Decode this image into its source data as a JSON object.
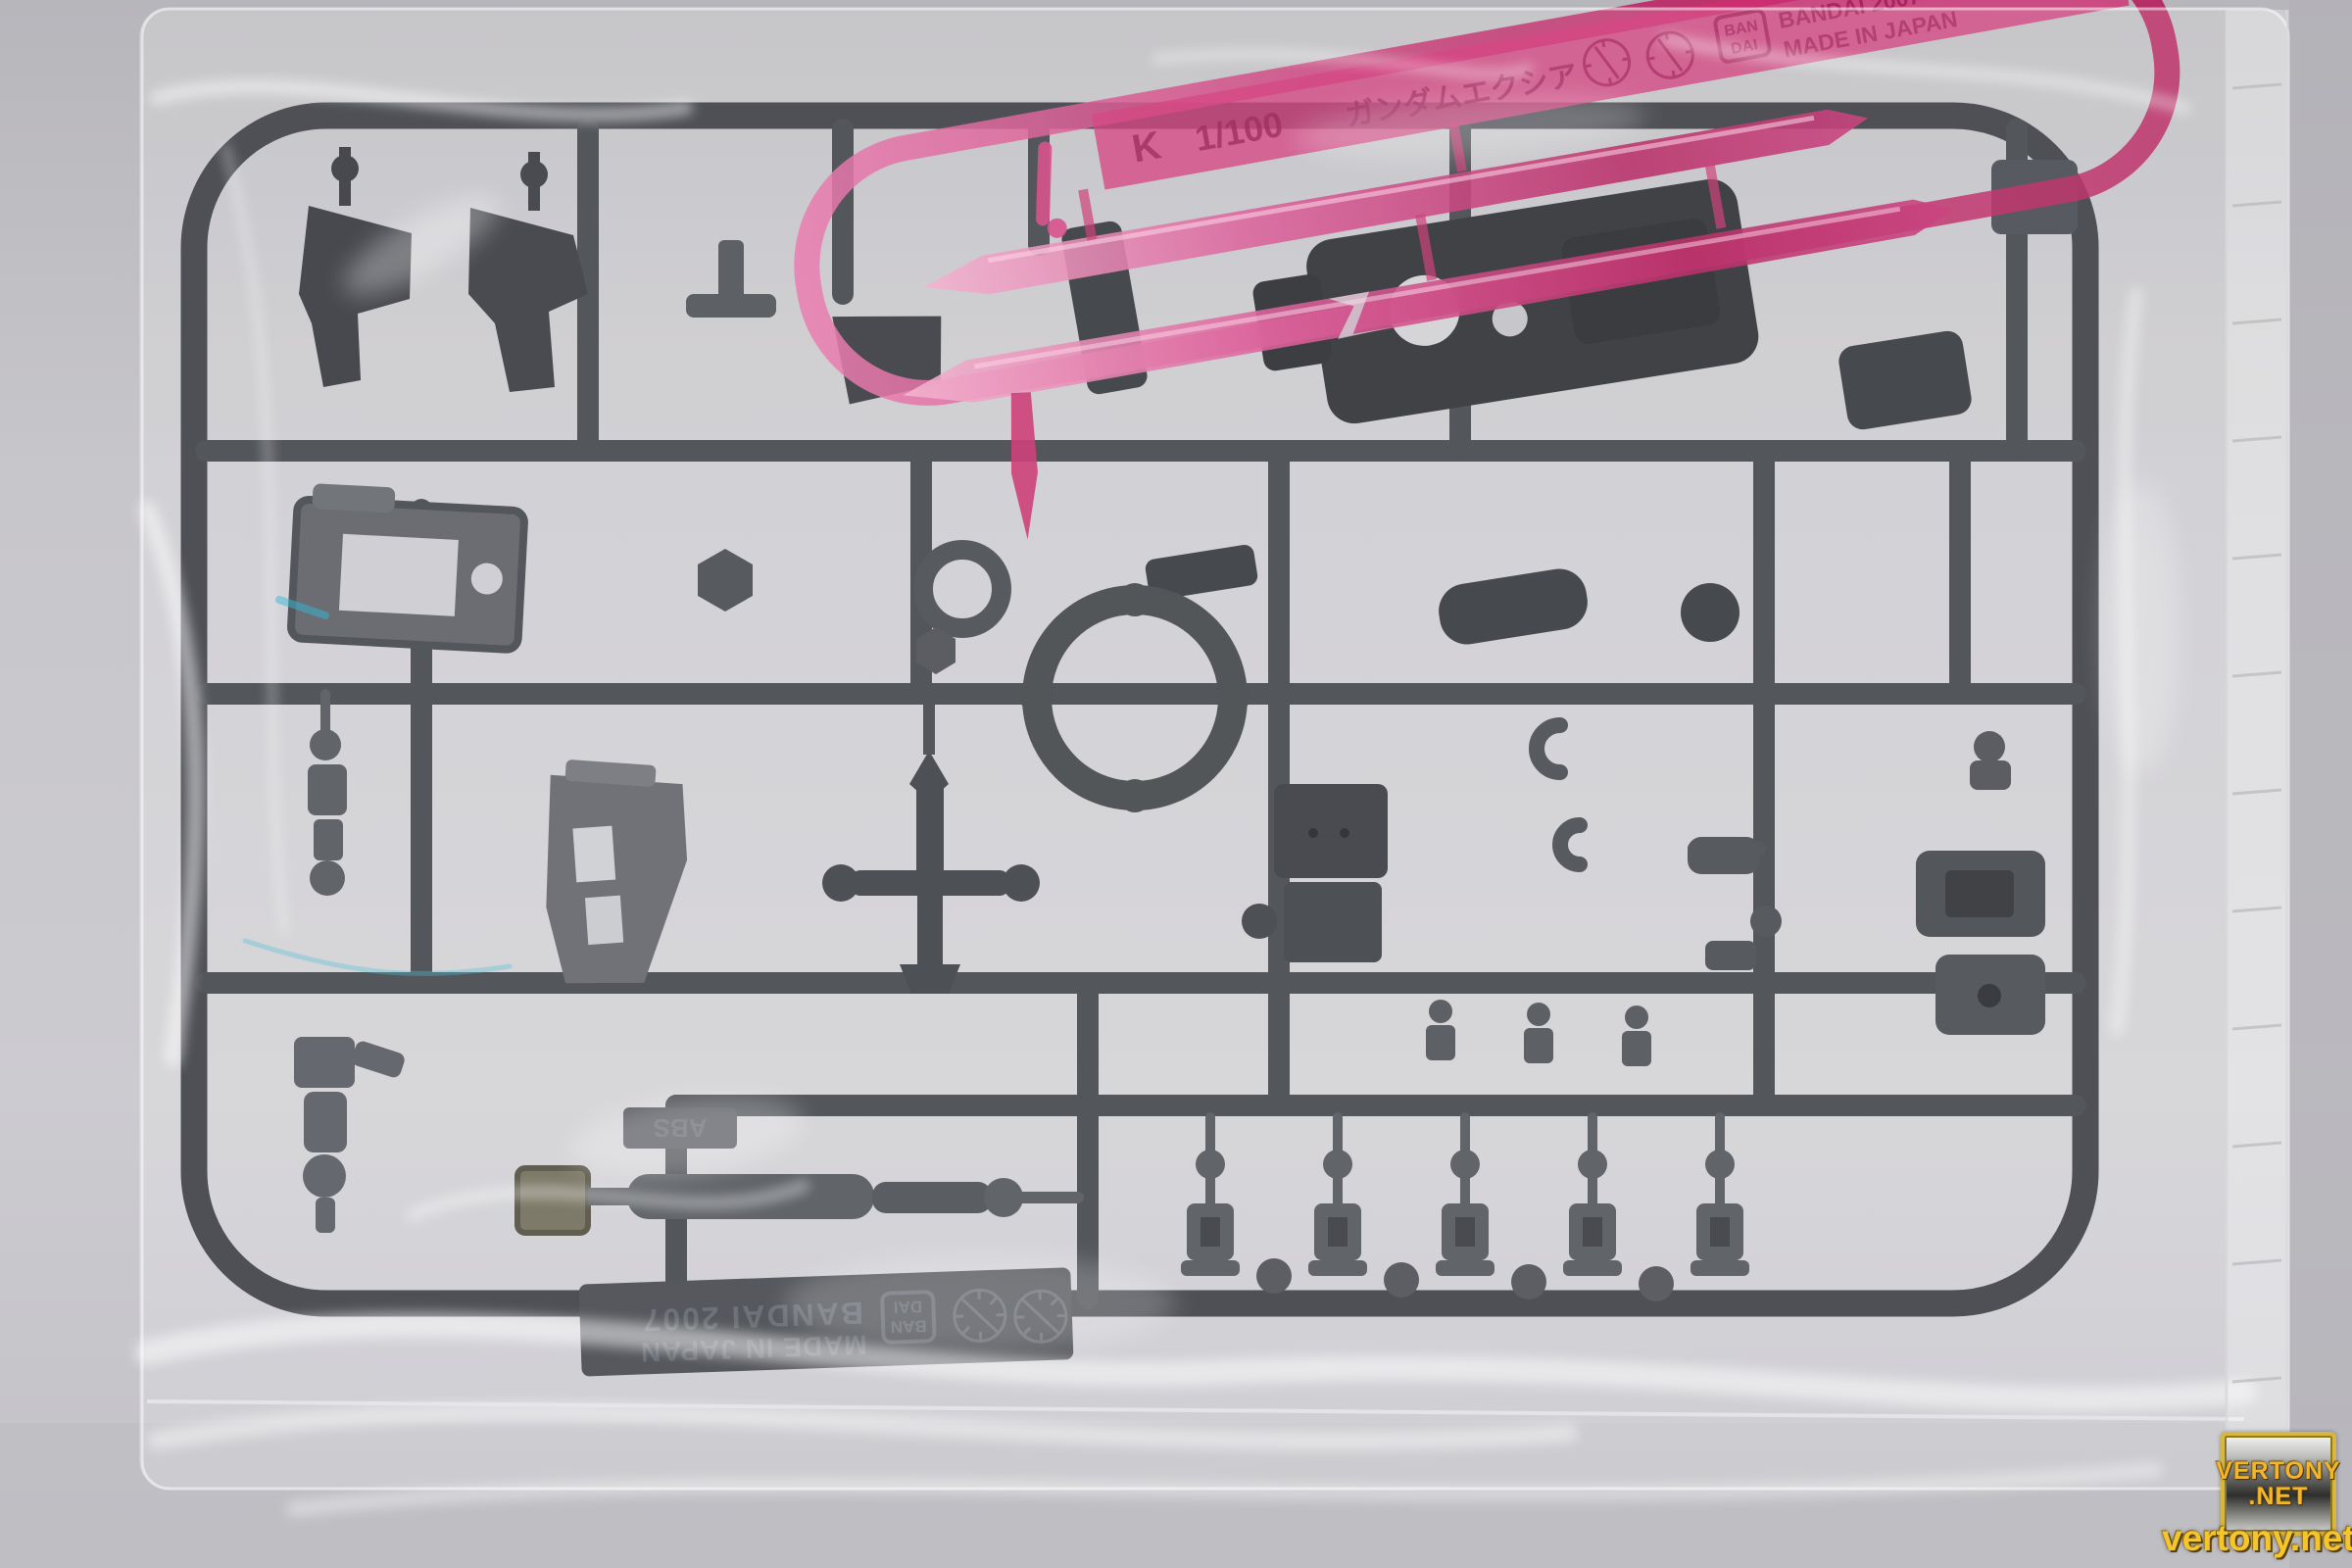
{
  "pink_runner_tag": {
    "runner_letter": "K",
    "scale": "1/100",
    "kit_name": "ガンダムエクシア",
    "logo_line1": "BAN",
    "logo_line2": "DAI",
    "brand": "BANDAI 2007",
    "origin": "MADE IN JAPAN"
  },
  "dark_runner_tag": {
    "brand": "BANDAI 2007",
    "origin": "MADE IN JAPAN",
    "logo_line1": "BAN",
    "logo_line2": "DAI",
    "material": "ABS"
  },
  "watermark": {
    "badge_line1": "VERTONY",
    "badge_line2": ".NET",
    "site_url": "vertony.net"
  },
  "colors": {
    "background": "#c6c5ca",
    "sprue_dark": "#34373d",
    "sprue_mid": "#4a4d53",
    "part_light_gray": "#5b5e63",
    "pink_clear": "#c72667",
    "pink_deep": "#8e0f49",
    "watermark_gold": "#f2b62c"
  }
}
